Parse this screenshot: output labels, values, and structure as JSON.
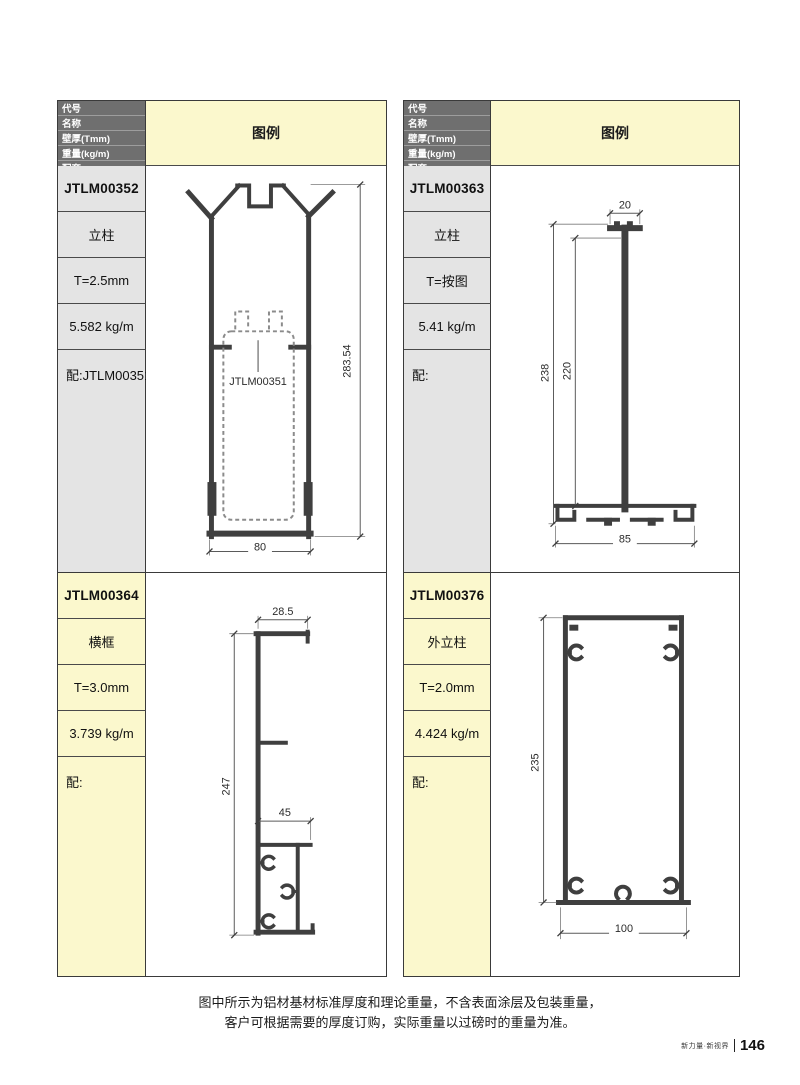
{
  "page": {
    "footnote": [
      "图中所示为铝材基材标准厚度和理论重量，不含表面涂层及包装重量，",
      "客户可根据需要的厚度订购，实际重量以过磅时的重量为准。"
    ],
    "footer_tagline": "新力量·新视界",
    "page_number": "146"
  },
  "table": {
    "header_labels": [
      "代号",
      "名称",
      "壁厚(Tmm)",
      "重量(kg/m)",
      "配套"
    ],
    "legend_label": "图例"
  },
  "colors": {
    "legend_bg": "#FBF8CD",
    "header_bg": "#6F6F6F",
    "gray_cell_bg": "#E4E4E4",
    "profile_line": "#3F3F3F"
  },
  "profiles": [
    {
      "code": "JTLM00352",
      "name": "立柱",
      "thickness": "T=2.5mm",
      "weight": "5.582 kg/m",
      "match": "配:JTLM00351",
      "drawing": {
        "height_dim": "283.54",
        "width_dim": "80",
        "inner_label": "JTLM00351"
      }
    },
    {
      "code": "JTLM00363",
      "name": "立柱",
      "thickness": "T=按图",
      "weight": "5.41 kg/m",
      "match": "配:",
      "drawing": {
        "top_dim": "20",
        "outer_height_dim": "238",
        "inner_height_dim": "220",
        "width_dim": "85"
      }
    },
    {
      "code": "JTLM00364",
      "name": "横框",
      "thickness": "T=3.0mm",
      "weight": "3.739 kg/m",
      "match": "配:",
      "drawing": {
        "top_dim": "28.5",
        "height_dim": "247",
        "width_dim": "45"
      }
    },
    {
      "code": "JTLM00376",
      "name": "外立柱",
      "thickness": "T=2.0mm",
      "weight": "4.424 kg/m",
      "match": "配:",
      "drawing": {
        "height_dim": "235",
        "width_dim": "100"
      }
    }
  ]
}
